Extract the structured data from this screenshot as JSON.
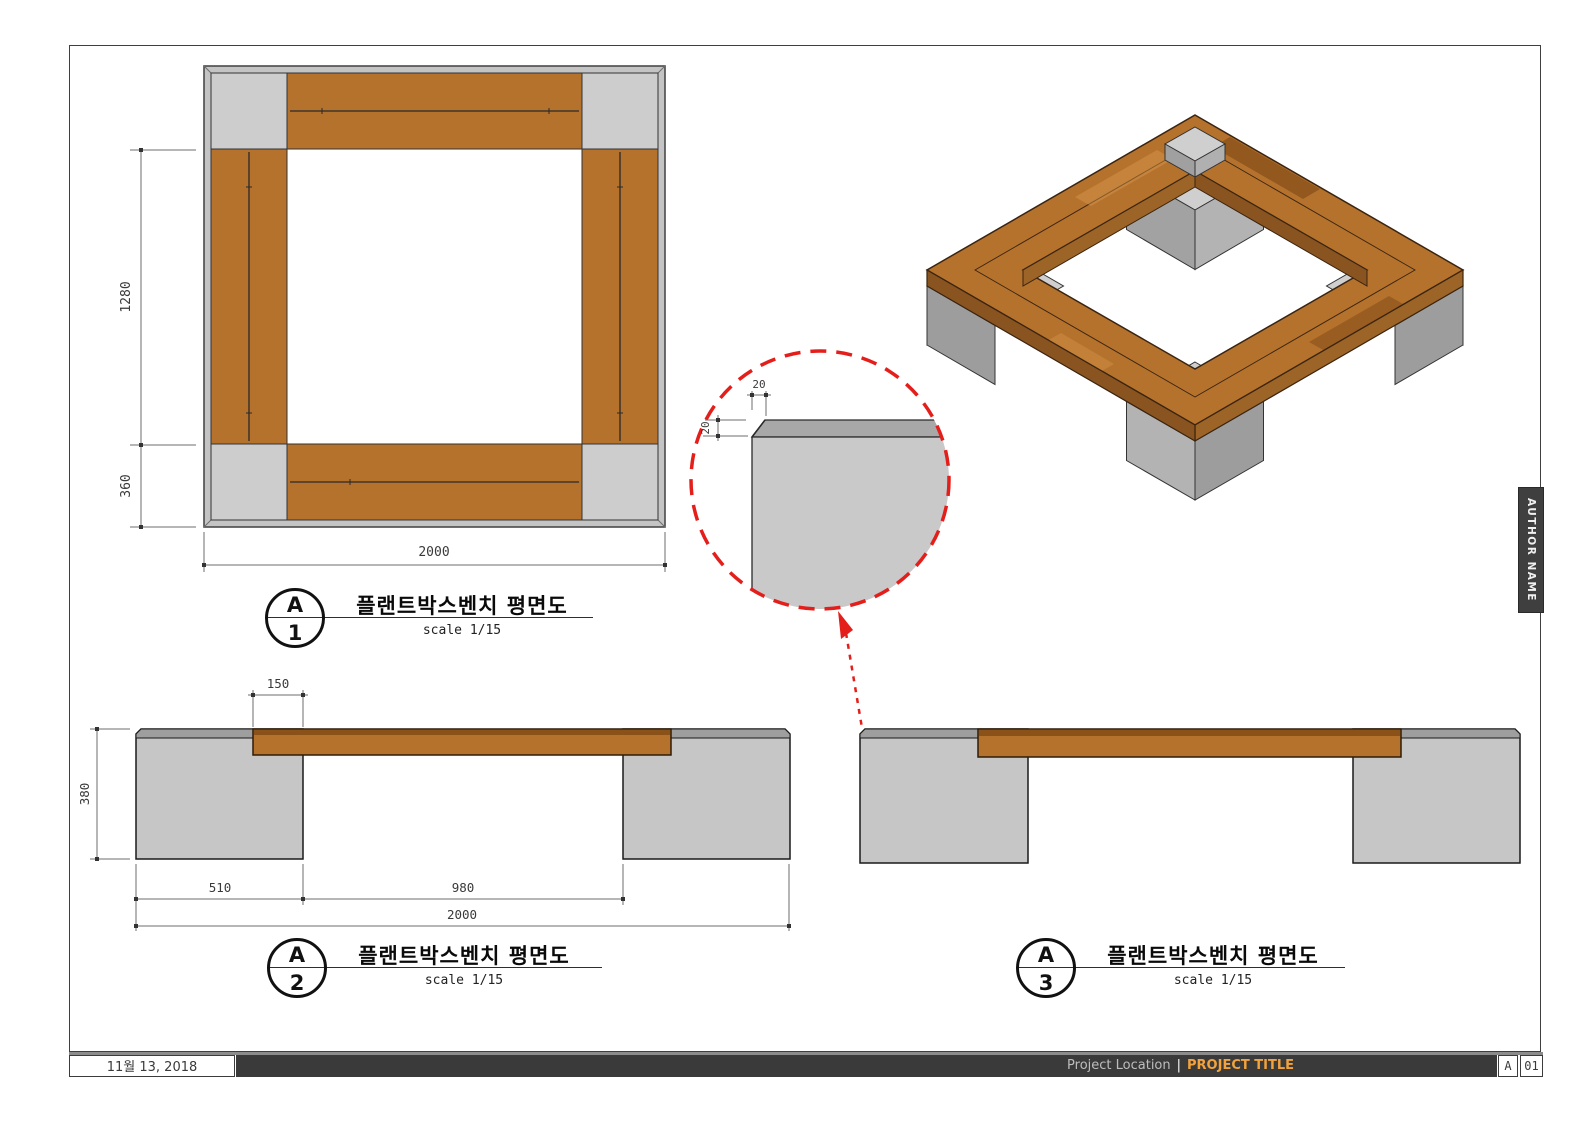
{
  "sheet": {
    "date": "11월 13, 2018",
    "project_location": "Project Location",
    "divider": "|",
    "project_title": "PROJECT TITLE",
    "sheet_letter": "A",
    "sheet_number": "01",
    "author": "AUTHOR NAME"
  },
  "colors": {
    "wood": "#b5722d",
    "wood_dark": "#8a5118",
    "wood_shadow": "#9c6426",
    "concrete": "#c9c9c9",
    "concrete_top": "#9e9e9e",
    "detail_red": "#e41e1a",
    "accent_orange": "#f2a33c",
    "bar_dark": "#3a3a3a"
  },
  "views": {
    "plan": {
      "letter": "A",
      "number": "1",
      "title": "플랜트박스벤치 평면도",
      "scale": "scale 1/15",
      "dims": {
        "total_width": "2000",
        "inner_height": "1280",
        "corner": "360"
      }
    },
    "front": {
      "letter": "A",
      "number": "2",
      "title": "플랜트박스벤치 평면도",
      "scale": "scale 1/15",
      "dims": {
        "overlap": "150",
        "height": "380",
        "block": "510",
        "span": "980",
        "total": "2000"
      }
    },
    "side": {
      "letter": "A",
      "number": "3",
      "title": "플랜트박스벤치 평면도",
      "scale": "scale 1/15"
    },
    "detail": {
      "dims": {
        "chamfer_width": "20",
        "chamfer_height": "20"
      }
    }
  }
}
